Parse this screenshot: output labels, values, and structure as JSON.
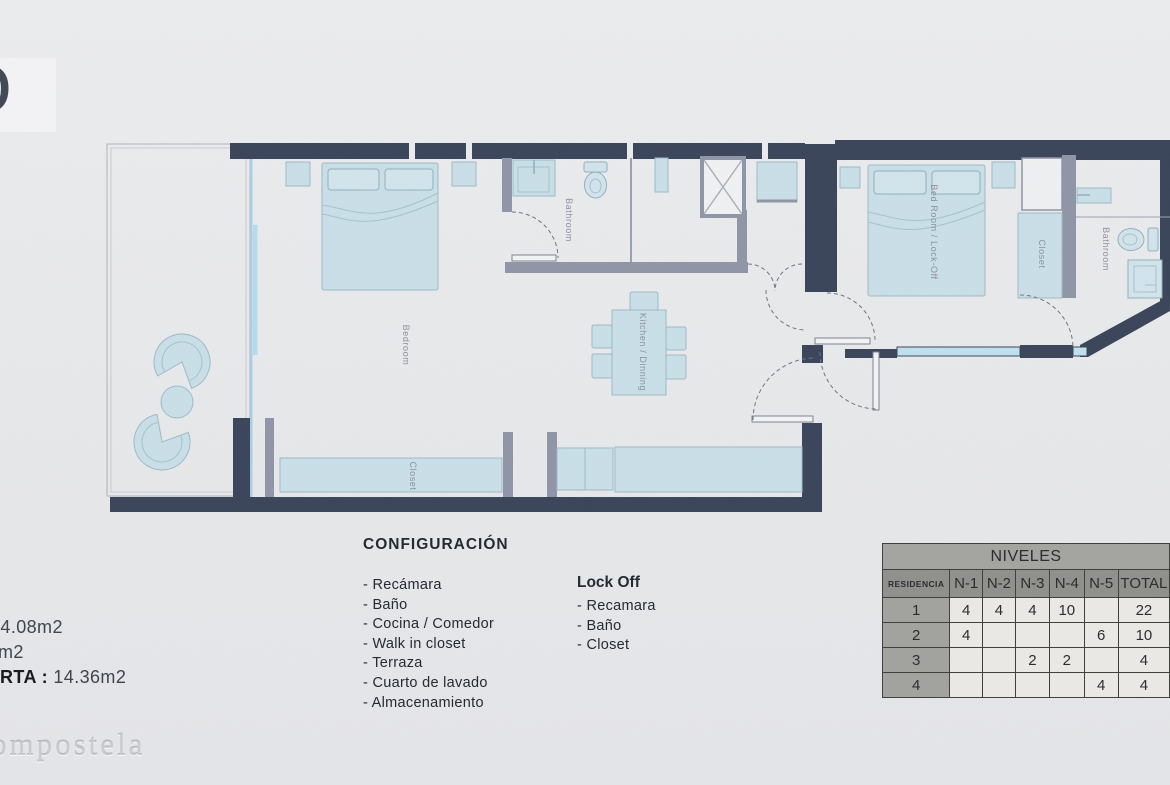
{
  "logo": {
    "letter": "D"
  },
  "areas": {
    "line1": "34.08m2",
    "line2": "m2",
    "line3_label": "RTA :",
    "line3_value": "14.36m2"
  },
  "watermark": "ompostela",
  "config": {
    "heading": "CONFIGURACIÓN",
    "items": [
      "- Recámara",
      "- Baño",
      "- Cocina / Comedor",
      "- Walk in closet",
      "- Terraza",
      "- Cuarto de lavado",
      "- Almacenamiento"
    ]
  },
  "lockoff": {
    "heading": "Lock Off",
    "items": [
      "- Recamara",
      "- Baño",
      "- Closet"
    ]
  },
  "floorplan": {
    "labels": {
      "bedroom": "Bedroom",
      "bathroom_main": "Bathroom",
      "closet_main": "Closet",
      "kitchen": "Kitchen / Dinning",
      "lockoff_bedroom": "Bed Room / Lock-Off",
      "closet_lockoff": "Closet",
      "bathroom_lockoff": "Bathroom"
    }
  },
  "table": {
    "title": "NIVELES",
    "columns": [
      "RESIDENCIA",
      "N-1",
      "N-2",
      "N-3",
      "N-4",
      "N-5",
      "TOTAL"
    ],
    "rows": [
      {
        "cells": [
          "1",
          "4",
          "4",
          "4",
          "10",
          "",
          "22"
        ]
      },
      {
        "cells": [
          "2",
          "4",
          "",
          "",
          "",
          "6",
          "10"
        ]
      },
      {
        "cells": [
          "3",
          "",
          "",
          "2",
          "2",
          "",
          "4"
        ]
      },
      {
        "cells": [
          "4",
          "",
          "",
          "",
          "",
          "4",
          "4"
        ]
      }
    ]
  },
  "colors": {
    "wall": "#3a4459",
    "interior_wall": "#8f95a6",
    "furniture": "#c9dfe7",
    "glass": "#a9cfe2"
  }
}
